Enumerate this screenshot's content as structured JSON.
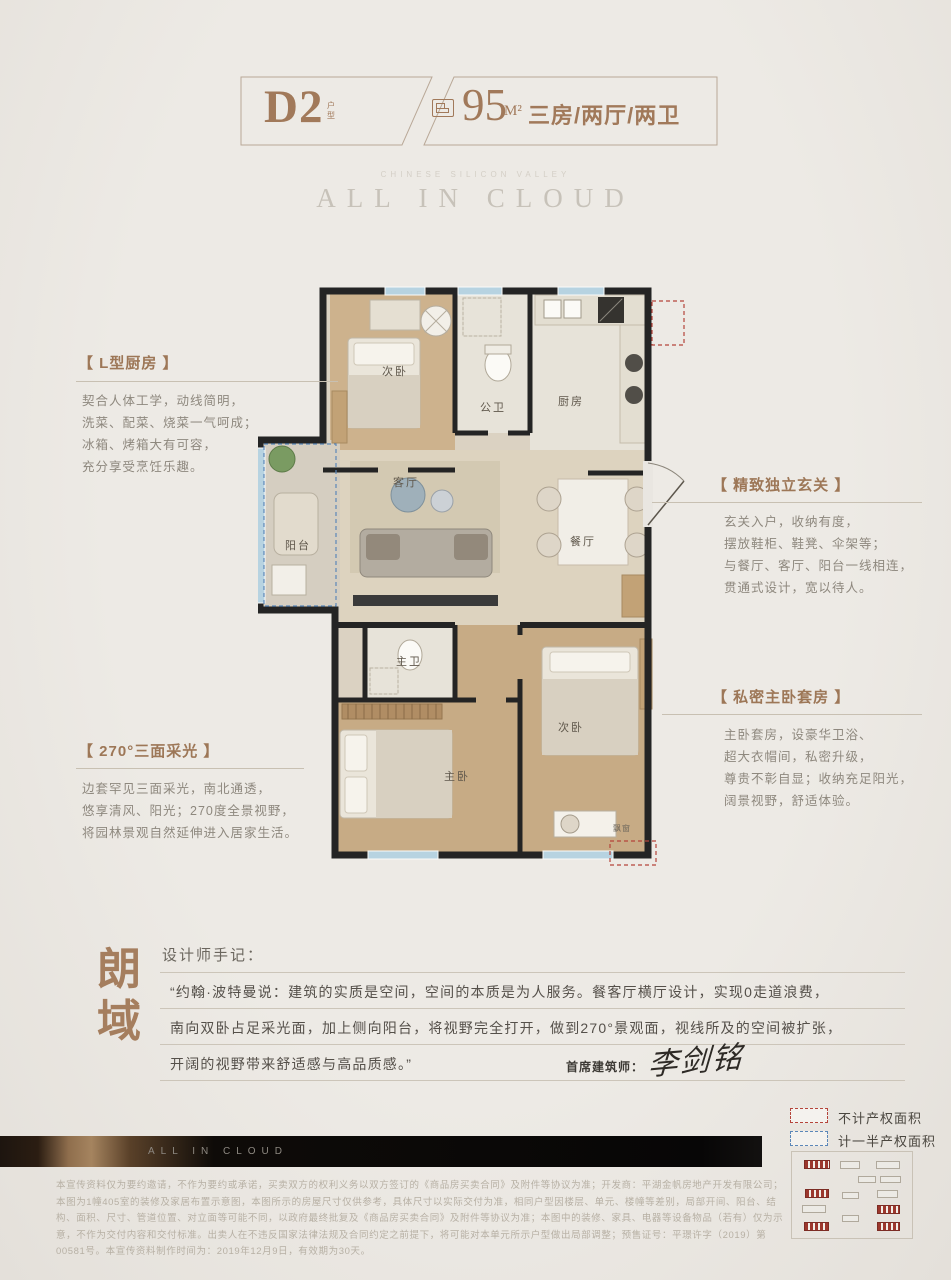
{
  "header": {
    "plan_code": "D2",
    "plan_type_label": "户型",
    "area_number": "95",
    "area_unit": "M²",
    "rooms_summary": "三房/两厅/两卫"
  },
  "brand": {
    "tagline": "CHINESE SILICON VALLEY",
    "name": "ALL IN CLOUD"
  },
  "floorplan": {
    "rooms": [
      "次卧",
      "公卫",
      "厨房",
      "阳台",
      "客厅",
      "餐厅",
      "主卫",
      "主卧",
      "次卧",
      "飘窗"
    ]
  },
  "features": [
    {
      "title": "【 L型厨房 】",
      "lines": [
        "契合人体工学，动线简明，",
        "洗菜、配菜、烧菜一气呵成；",
        "冰箱、烤箱大有可容，",
        "充分享受烹饪乐趣。"
      ]
    },
    {
      "title": "【 精致独立玄关 】",
      "lines": [
        "玄关入户，收纳有度，",
        "摆放鞋柜、鞋凳、伞架等；",
        "与餐厅、客厅、阳台一线相连，",
        "贯通式设计，宽以待人。"
      ]
    },
    {
      "title": "【 270°三面采光 】",
      "lines": [
        "边套罕见三面采光，南北通透，",
        "悠享清风、阳光；270度全景视野，",
        "将园林景观自然延伸进入居家生活。"
      ]
    },
    {
      "title": "【 私密主卧套房 】",
      "lines": [
        "主卧套房，设豪华卫浴、",
        "超大衣帽间，私密升级，",
        "尊贵不彰自显；收纳充足阳光，",
        "阔景视野，舒适体验。"
      ]
    }
  ],
  "designer_note": {
    "brand_chars": [
      "朗",
      "域"
    ],
    "heading": "设计师手记：",
    "lines": [
      "“约翰·波特曼说：建筑的实质是空间，空间的本质是为人服务。餐客厅横厅设计，实现0走道浪费，",
      "南向双卧占足采光面，加上侧向阳台，将视野完全打开，做到270°景观面，视线所及的空间被扩张，",
      "开阔的视野带来舒适感与高品质感。”"
    ],
    "architect_label": "首席建筑师：",
    "architect_name": "李剑铭"
  },
  "legend": {
    "no_property_area": "不计产权面积",
    "half_property_area": "计一半产权面积"
  },
  "keyplan": {
    "buildings": [
      {
        "x": 12,
        "y": 8,
        "w": 26,
        "h": 9,
        "hl": true
      },
      {
        "x": 48,
        "y": 9,
        "w": 20,
        "h": 8,
        "hl": false
      },
      {
        "x": 84,
        "y": 9,
        "w": 24,
        "h": 8,
        "hl": false
      },
      {
        "x": 66,
        "y": 24,
        "w": 18,
        "h": 7,
        "hl": false
      },
      {
        "x": 88,
        "y": 24,
        "w": 21,
        "h": 7,
        "hl": false
      },
      {
        "x": 13,
        "y": 37,
        "w": 24,
        "h": 9,
        "hl": true
      },
      {
        "x": 50,
        "y": 40,
        "w": 17,
        "h": 7,
        "hl": false
      },
      {
        "x": 85,
        "y": 38,
        "w": 21,
        "h": 8,
        "hl": false
      },
      {
        "x": 10,
        "y": 53,
        "w": 24,
        "h": 8,
        "hl": false
      },
      {
        "x": 85,
        "y": 53,
        "w": 23,
        "h": 9,
        "hl": true
      },
      {
        "x": 50,
        "y": 63,
        "w": 17,
        "h": 7,
        "hl": false
      },
      {
        "x": 12,
        "y": 70,
        "w": 25,
        "h": 9,
        "hl": true
      },
      {
        "x": 85,
        "y": 70,
        "w": 23,
        "h": 9,
        "hl": true
      }
    ]
  },
  "footer": {
    "banner_text": "ALL IN CLOUD",
    "disclaimer": [
      "本宣传资料仅为要约邀请，不作为要约或承诺，买卖双方的权利义务以双方签订的《商品房买卖合同》及附件等协议为准；开发商：平湖金帆房地产开发有限公司；",
      "本图为1幢405室的装修及家居布置示意图，本图所示的房屋尺寸仅供参考，具体尺寸以实际交付为准，相同户型因楼层、单元、楼幢等差别，局部开间、阳台、结",
      "构、面积、尺寸、管道位置、对立面等可能不同，以政府最终批复及《商品房买卖合同》及附件等协议为准；本图中的装修、家具、电器等设备物品（若有）仅为示",
      "意，不作为交付内容和交付标准。出卖人在不违反国家法律法规及合同约定之前提下，将可能对本单元所示户型做出局部调整；预售证号：平璟许字（2019）第",
      "00581号。本宣传资料制作时间为：2019年12月9日，有效期为30天。"
    ]
  },
  "colors": {
    "accent": "#a1795a",
    "legend_red": "#b5443a",
    "legend_blue": "#5b87b8"
  }
}
